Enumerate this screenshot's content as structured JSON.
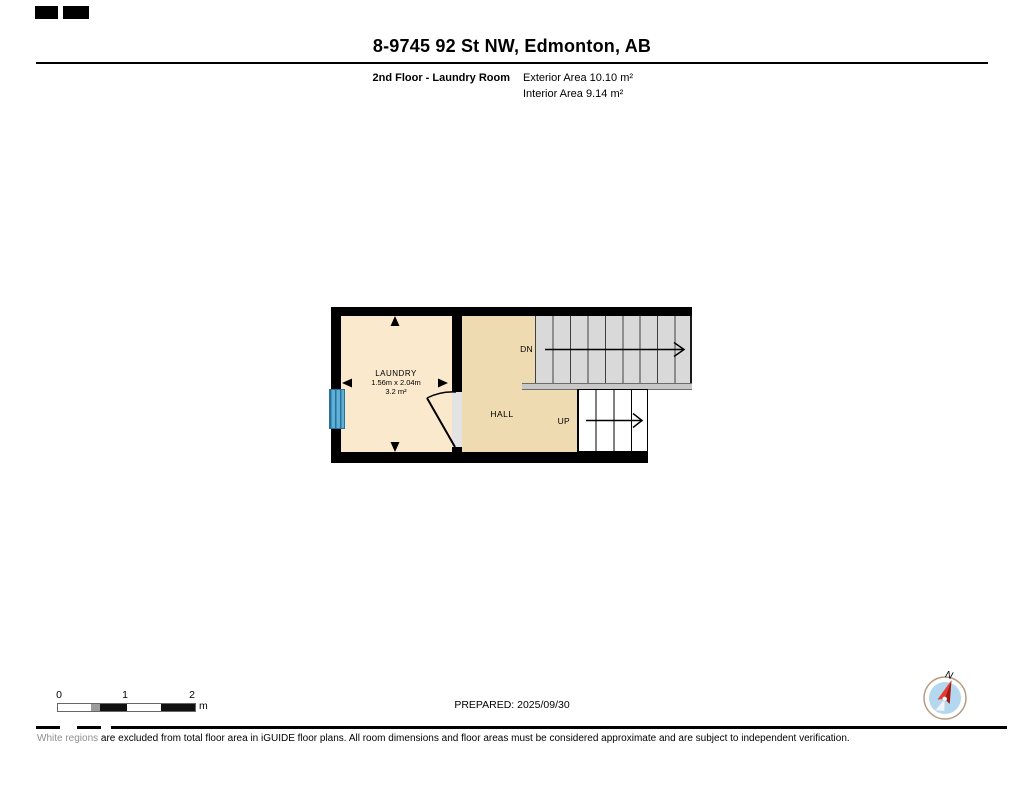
{
  "header": {
    "title": "8-9745 92 St NW, Edmonton, AB",
    "floor_label": "2nd Floor - Laundry Room",
    "exterior_area": "Exterior Area 10.10 m²",
    "interior_area": "Interior Area 9.14 m²"
  },
  "floorplan": {
    "laundry": {
      "name": "LAUNDRY",
      "dimensions": "1.56m x 2.04m",
      "area": "3.2 m²"
    },
    "hall": {
      "name": "HALL"
    },
    "stairs_down_label": "DN",
    "stairs_up_label": "UP"
  },
  "scale_bar": {
    "tick_0": "0",
    "tick_1": "1",
    "tick_2": "2",
    "unit": "m"
  },
  "footer": {
    "prepared": "PREPARED: 2025/09/30",
    "compass_north": "N",
    "disclaimer_highlight": "White regions",
    "disclaimer_rest": " are excluded from total floor area in iGUIDE floor plans. All room dimensions and floor areas must be considered approximate and are subject to independent verification."
  },
  "colors": {
    "wall": "#000000",
    "laundry_fill": "#fbe9cd",
    "hall_fill": "#efdbb2",
    "stairs_down_fill": "#d9d9d9",
    "stairs_up_fill": "#ffffff",
    "railing_fill": "#c8c8c8",
    "window_blue": "#5fb0d6",
    "compass_disc_blue": "#b3d7ee",
    "compass_needle_red": "#cf2128"
  }
}
